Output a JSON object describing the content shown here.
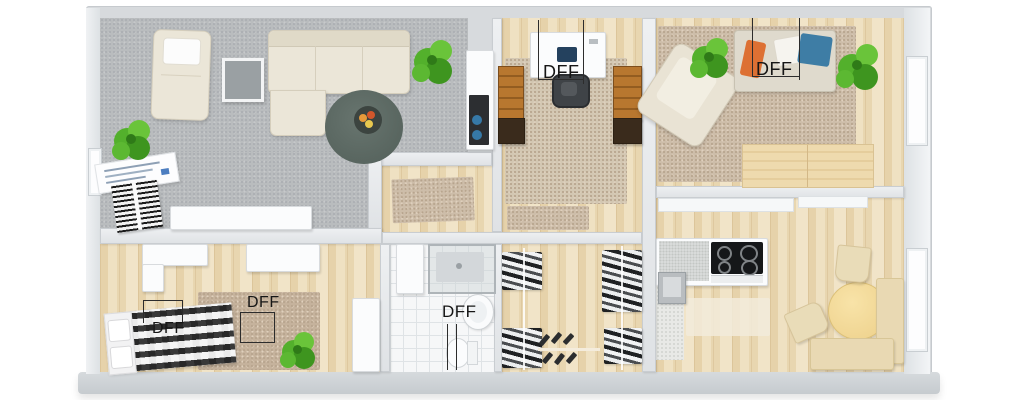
{
  "floorplan": {
    "type": "3d-apartment-floor-plan",
    "labels": {
      "office_roof_window": "DFF",
      "bedroom_right_roof_window": "DFF",
      "bedroom_left_roof_window_1": "DFF",
      "bedroom_left_roof_window_2": "DFF",
      "bathroom_roof_window": "DFF"
    },
    "colors": {
      "background": "#ffffff",
      "wall": "#d7dadd",
      "wall_front_face": "#c9cdd1",
      "living_carpet": "#b9bcbe",
      "wood_floor": "#ead9b8",
      "area_rug": "#cdbda9",
      "round_rug": "#5c6a64",
      "bathroom_tile": "#f6f7f8",
      "cooktop": "#17181a",
      "dining_table": "#f2d68e",
      "plant_green": "#4faa28",
      "pillow_orange": "#dd7033",
      "pillow_blue": "#3e7da5",
      "annotation_text": "#161616"
    }
  }
}
